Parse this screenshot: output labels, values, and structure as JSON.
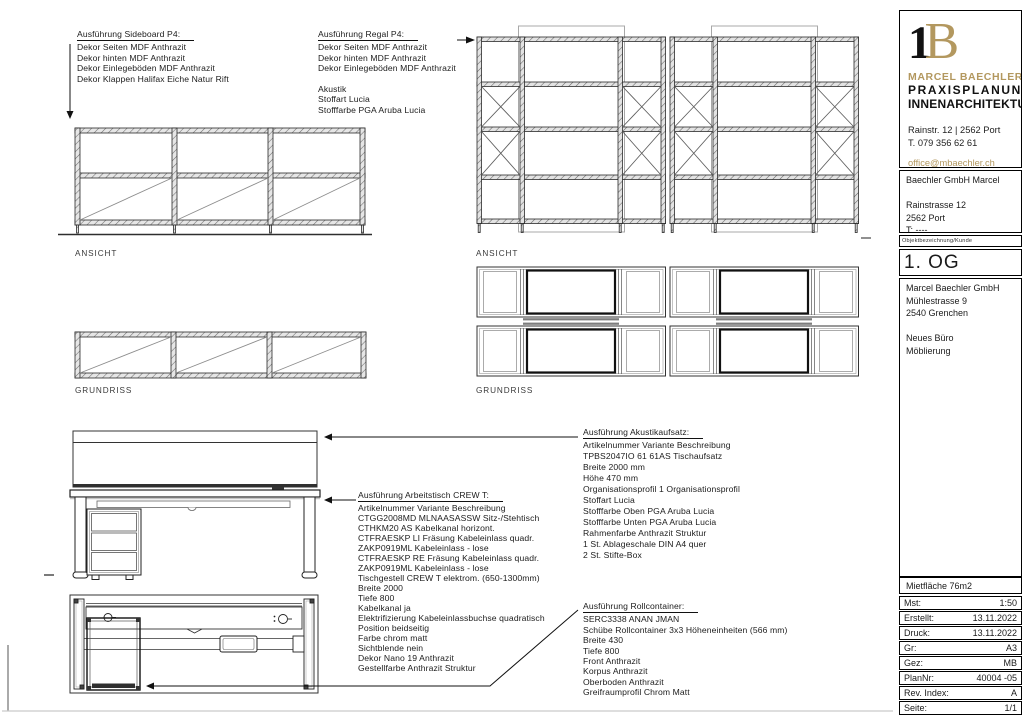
{
  "colors": {
    "gold": "#b3985f",
    "line": "#1a1a1a"
  },
  "annotations": {
    "sideboard": {
      "title": "Ausführung Sideboard P4:",
      "lines": [
        "Dekor Seiten MDF Anthrazit",
        "Dekor hinten MDF Anthrazit",
        "Dekor Einlegeböden MDF Anthrazit",
        "Dekor Klappen Halifax Eiche Natur Rift"
      ]
    },
    "regal": {
      "title": "Ausführung Regal P4:",
      "lines": [
        "Dekor Seiten MDF Anthrazit",
        "Dekor hinten MDF Anthrazit",
        "Dekor Einlegeböden MDF Anthrazit",
        "",
        "Akustik",
        "Stoffart Lucia",
        "Stofffarbe PGA Aruba Lucia"
      ]
    },
    "akustikaufsatz": {
      "title": "Ausführung Akustikaufsatz:",
      "lines": [
        "Artikelnummer Variante Beschreibung",
        "TPBS2047IO 61 61AS Tischaufsatz",
        "Breite 2000 mm",
        "Höhe 470 mm",
        "Organisationsprofil 1 Organisationsprofil",
        "Stoffart Lucia",
        "Stofffarbe Oben PGA Aruba Lucia",
        "Stofffarbe Unten PGA Aruba Lucia",
        "Rahmenfarbe Anthrazit Struktur",
        "1 St. Ablageschale DIN A4 quer",
        "2 St. Stifte-Box"
      ]
    },
    "arbeitstisch": {
      "title": "Ausführung Arbeitstisch CREW T:",
      "lines": [
        "Artikelnummer Variante Beschreibung",
        "CTGG2008MD MLNAASASSW Sitz-/Stehtisch",
        "CTHKM20 AS Kabelkanal horizont.",
        "CTFRAESKP LI Fräsung Kabeleinlass quadr.",
        "ZAKP0919ML Kabeleinlass - lose",
        "CTFRAESKP RE Fräsung Kabeleinlass quadr.",
        "ZAKP0919ML Kabeleinlass - lose",
        "Tischgestell CREW T elektrom. (650-1300mm)",
        "Breite 2000",
        "Tiefe 800",
        "Kabelkanal ja",
        "Elektrifizierung Kabeleinlassbuchse quadratisch",
        "Position beidseitig",
        "Farbe chrom matt",
        "Sichtblende nein",
        "Dekor Nano 19 Anthrazit",
        "Gestellfarbe Anthrazit Struktur"
      ]
    },
    "rollcontainer": {
      "title": "Ausführung Rollcontainer:",
      "lines": [
        "SERC3338 ANAN JMAN",
        "Schübe Rollcontainer 3x3 Höheneinheiten (566 mm)",
        "Breite 430",
        "Tiefe 800",
        "Front Anthrazit",
        "Korpus Anthrazit",
        "Oberboden Anthrazit",
        "Greifraumprofil Chrom Matt"
      ]
    }
  },
  "view_labels": {
    "sideboard_ansicht": "ANSICHT",
    "sideboard_grundriss": "GRUNDRISS",
    "regal_ansicht": "ANSICHT",
    "regal_grundriss": "GRUNDRISS"
  },
  "title_block": {
    "brand": {
      "mark_black": "1",
      "mark_gold": "B",
      "name": "MARCEL BAECHLER",
      "line1": "PRAXISPLANUNG",
      "line2": "INNENARCHITEKTUR",
      "address": "Rainstr. 12 | 2562 Port",
      "phone": "T. 079 356 62 61",
      "email": "office@mbaechler.ch",
      "web": "marcelbaechler.ch"
    },
    "client_box": {
      "lines": [
        "Baechler GmbH Marcel",
        "",
        "Rainstrasse 12",
        "2562 Port",
        "T: ----"
      ]
    },
    "object_label": "Objektbezeichnung/Kunde",
    "floor": "1. OG",
    "project_box": {
      "lines": [
        "Marcel Baechler GmbH",
        "Mühlestrasse 9",
        "2540 Grenchen",
        "",
        "Neues Büro",
        "Möblierung"
      ]
    },
    "area": "Mietfläche 76m2",
    "meta_rows": [
      {
        "label": "Mst:",
        "value": "1:50"
      },
      {
        "label": "Erstellt:",
        "value": "13.11.2022"
      },
      {
        "label": "Druck:",
        "value": "13.11.2022"
      },
      {
        "label": "Gr:",
        "value": "A3"
      },
      {
        "label": "Gez:",
        "value": "MB"
      },
      {
        "label": "PlanNr:",
        "value": "40004 -05"
      },
      {
        "label": "Rev. Index:",
        "value": "A"
      },
      {
        "label": "Seite:",
        "value": "1/1"
      }
    ]
  }
}
